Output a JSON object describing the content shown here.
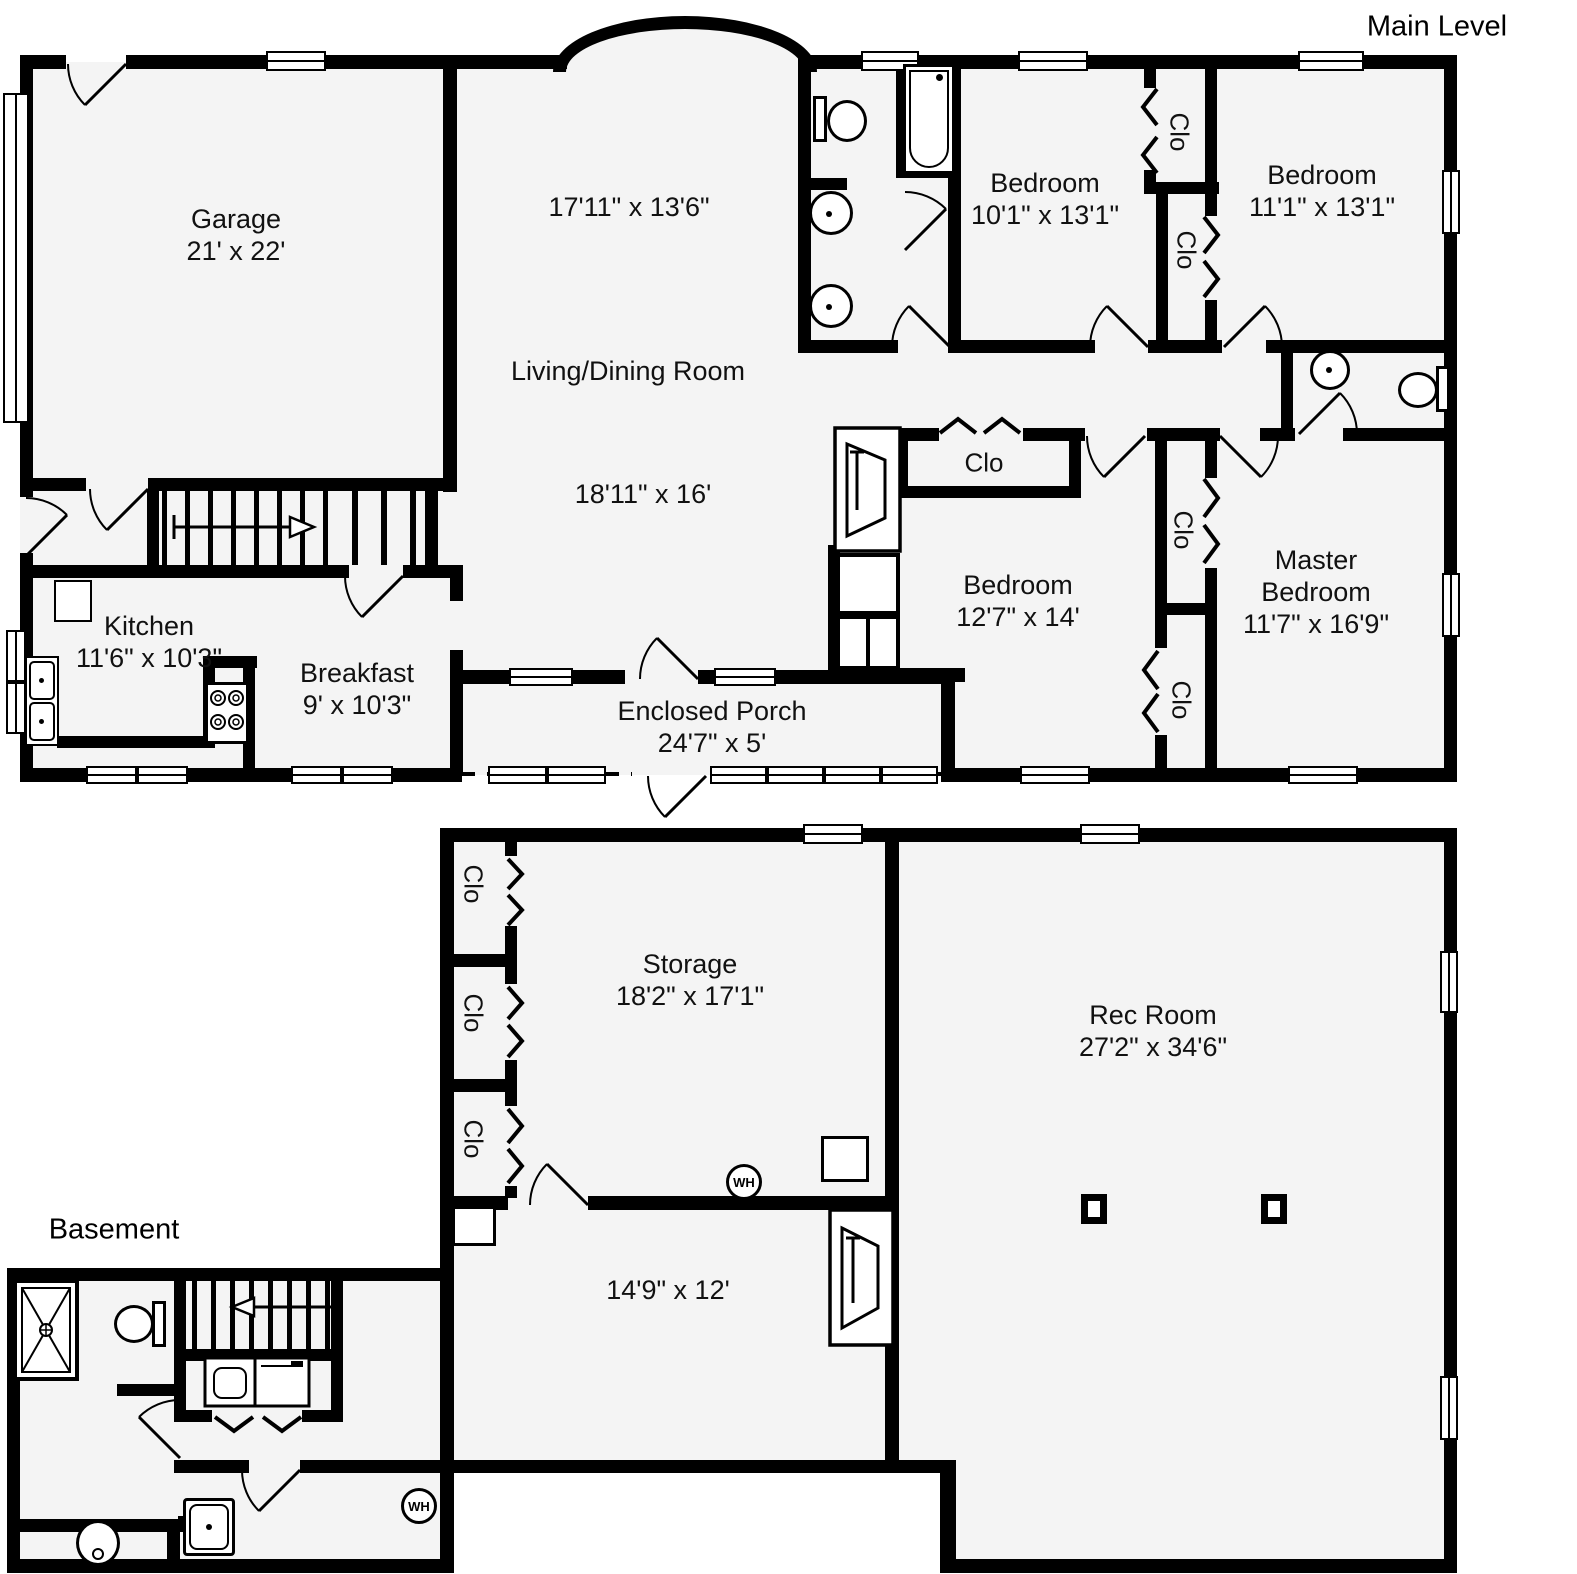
{
  "plans": {
    "main": {
      "title": "Main Level"
    },
    "basement": {
      "title": "Basement"
    }
  },
  "rooms": {
    "garage": {
      "name": "Garage",
      "dims": "21' x 22'"
    },
    "dining_area": {
      "dims": "17'11\" x 13'6\""
    },
    "living_dining": {
      "name": "Living/Dining Room",
      "dims": "18'11\" x 16'"
    },
    "bedroom_top_middle": {
      "name": "Bedroom",
      "dims": "10'1\" x 13'1\""
    },
    "bedroom_top_right": {
      "name": "Bedroom",
      "dims": "11'1\" x 13'1\""
    },
    "bedroom_middle": {
      "name": "Bedroom",
      "dims": "12'7\" x 14'"
    },
    "master_bedroom": {
      "name": "Master Bedroom",
      "dims": "11'7\" x 16'9\""
    },
    "kitchen": {
      "name": "Kitchen",
      "dims": "11'6\" x 10'3\""
    },
    "breakfast": {
      "name": "Breakfast",
      "dims": "9' x 10'3\""
    },
    "enclosed_porch": {
      "name": "Enclosed Porch",
      "dims": "24'7\" x 5'"
    },
    "storage": {
      "name": "Storage",
      "dims": "18'2\" x 17'1\""
    },
    "rec_room": {
      "name": "Rec Room",
      "dims": "27'2\" x 34'6\""
    },
    "basement_room": {
      "dims": "14'9\" x 12'"
    }
  },
  "labels": {
    "closet": "Clo",
    "water_heater": "WH"
  },
  "colors": {
    "wall": "#000000",
    "floor": "#f4f4f4",
    "background": "#ffffff"
  }
}
